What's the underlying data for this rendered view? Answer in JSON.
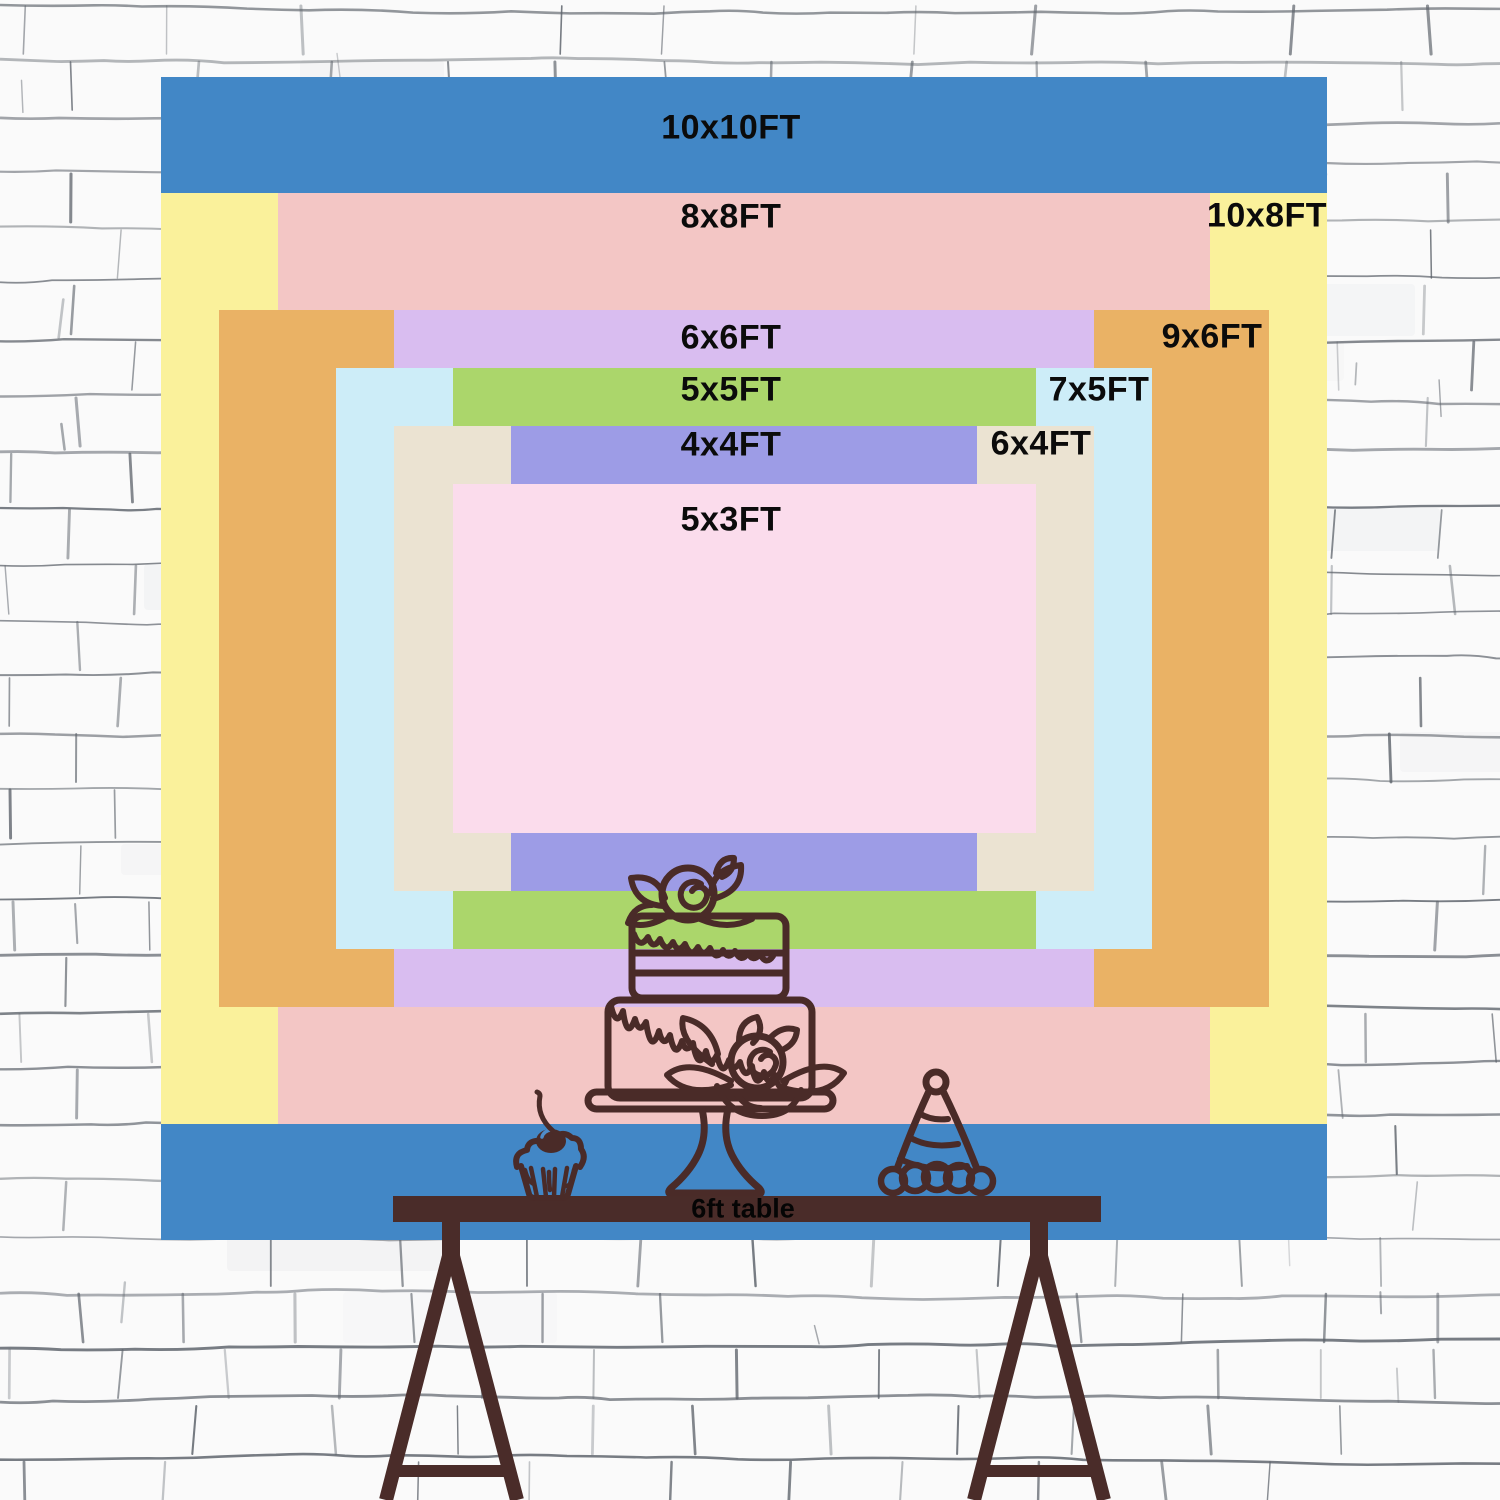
{
  "scene": {
    "description": "backdrop size comparison chart on white brick wall",
    "wall_bg": "#fafafa",
    "wall_line_color": "#5d636b"
  },
  "chart_data": {
    "type": "nested-size-comparison",
    "unit": "FT",
    "area": {
      "x": 161,
      "y": 77,
      "width": 1166,
      "height": 1163,
      "feet": 10
    },
    "label_color": "#0b0b0b",
    "sizes": [
      {
        "label": "10x10FT",
        "w_ft": 10,
        "h_ft": 10,
        "color": "#4287c6",
        "label_x": 731,
        "label_y": 128
      },
      {
        "label": "10x8FT",
        "w_ft": 10,
        "h_ft": 8,
        "color": "#faf19b",
        "label_x": 1267,
        "label_y": 216
      },
      {
        "label": "8x8FT",
        "w_ft": 8,
        "h_ft": 8,
        "color": "#f3c6c5",
        "label_x": 731,
        "label_y": 217
      },
      {
        "label": "9x6FT",
        "w_ft": 9,
        "h_ft": 6,
        "color": "#eab265",
        "label_x": 1212,
        "label_y": 337
      },
      {
        "label": "6x6FT",
        "w_ft": 6,
        "h_ft": 6,
        "color": "#d9bdf0",
        "label_x": 731,
        "label_y": 338
      },
      {
        "label": "7x5FT",
        "w_ft": 7,
        "h_ft": 5,
        "color": "#cdedf8",
        "label_x": 1099,
        "label_y": 390
      },
      {
        "label": "5x5FT",
        "w_ft": 5,
        "h_ft": 5,
        "color": "#abd66b",
        "label_x": 731,
        "label_y": 390
      },
      {
        "label": "6x4FT",
        "w_ft": 6,
        "h_ft": 4,
        "color": "#ebe3d2",
        "label_x": 1041,
        "label_y": 444
      },
      {
        "label": "4x4FT",
        "w_ft": 4,
        "h_ft": 4,
        "color": "#9d9ce6",
        "label_x": 731,
        "label_y": 445
      },
      {
        "label": "5x3FT",
        "w_ft": 5,
        "h_ft": 3,
        "color": "#fbdcec",
        "label_x": 731,
        "label_y": 520
      }
    ]
  },
  "table": {
    "label": "6ft table",
    "color": "#4a2c29",
    "text_color": "#050505"
  },
  "doodles": {
    "stroke_color": "#4a2b28",
    "items": [
      "cupcake",
      "birthday-cake",
      "party-hat",
      "trestle-table"
    ]
  }
}
